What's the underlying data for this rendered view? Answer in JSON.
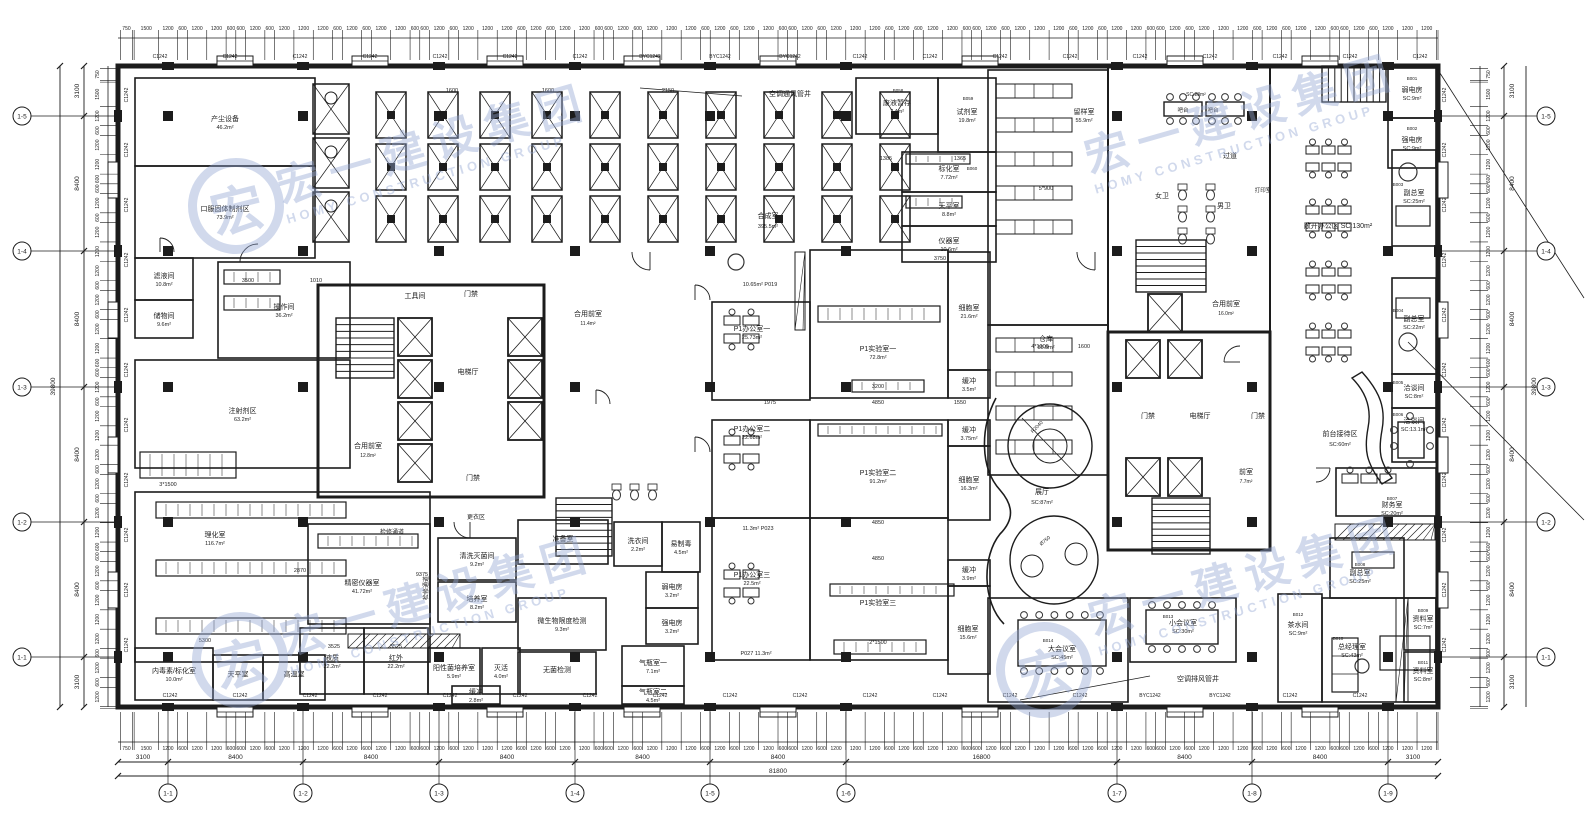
{
  "watermark": {
    "cn": "宏一建设集团",
    "en": "HOMY CONSTRUCTION GROUP",
    "logo_char": "宏",
    "color": "#93a7d4"
  },
  "window_label": "C1242",
  "window_label_alt": "BYC1242",
  "axis": {
    "h_total": "81800",
    "v_total": "39800",
    "h_spans": [
      [
        "3100",
        118,
        168
      ],
      [
        "8400",
        168,
        303
      ],
      [
        "8400",
        303,
        439
      ],
      [
        "8400",
        439,
        575
      ],
      [
        "8400",
        575,
        710
      ],
      [
        "8400",
        710,
        846
      ],
      [
        "16800",
        846,
        1117
      ],
      [
        "8400",
        1117,
        1252
      ],
      [
        "8400",
        1252,
        1388
      ],
      [
        "3100",
        1388,
        1438
      ]
    ],
    "v_spans": [
      [
        "3100",
        66,
        116
      ],
      [
        "8400",
        116,
        251
      ],
      [
        "8400",
        251,
        387
      ],
      [
        "8400",
        387,
        522
      ],
      [
        "8400",
        522,
        657
      ],
      [
        "3100",
        657,
        707
      ]
    ],
    "bottom_bubbles": [
      [
        "1-1",
        168
      ],
      [
        "1-2",
        303
      ],
      [
        "1-3",
        439
      ],
      [
        "1-4",
        575
      ],
      [
        "1-5",
        710
      ],
      [
        "1-6",
        846
      ],
      [
        "1-7",
        1117
      ],
      [
        "1-8",
        1252
      ],
      [
        "1-9",
        1388
      ]
    ],
    "left_bubbles": [
      [
        "1-5",
        116
      ],
      [
        "1-4",
        251
      ],
      [
        "1-3",
        387
      ],
      [
        "1-2",
        522
      ],
      [
        "1-1",
        657
      ]
    ],
    "tick_cycle": [
      1200,
      600,
      1200,
      1200,
      600,
      600,
      1200,
      600,
      1200,
      1200,
      1200,
      600
    ],
    "lead_in": [
      150,
      750,
      100,
      1500
    ]
  },
  "rooms": [
    {
      "n": "产尘设备",
      "a": "46.2m²",
      "r": [
        135,
        78,
        180,
        88
      ]
    },
    {
      "n": "口服固体制剂区",
      "a": "73.9m²",
      "r": [
        135,
        166,
        180,
        92
      ]
    },
    {
      "n": "滤液间",
      "a": "10.8m²",
      "r": [
        135,
        258,
        58,
        42
      ]
    },
    {
      "n": "储物间",
      "a": "9.6m²",
      "r": [
        135,
        300,
        58,
        38
      ]
    },
    {
      "n": "操作间",
      "a": "36.2m²",
      "r": [
        218,
        262,
        132,
        96
      ]
    },
    {
      "n": "注射剂区",
      "a": "63.2m²",
      "r": [
        135,
        360,
        215,
        108
      ]
    },
    {
      "n": "理化室",
      "a": "116.7m²",
      "r": [
        135,
        492,
        295,
        170
      ],
      "p": [
        215,
        538
      ]
    },
    {
      "n": "内毒素/标化室",
      "a": "10.0m²",
      "r": [
        135,
        648,
        78,
        52
      ]
    },
    {
      "n": "天平室",
      "a": "",
      "r": [
        213,
        655,
        50,
        45
      ]
    },
    {
      "n": "高温室",
      "a": "",
      "r": [
        263,
        655,
        62,
        45
      ]
    },
    {
      "n": "精密仪器室",
      "a": "41.72m²",
      "r": [
        308,
        524,
        122,
        100
      ],
      "p": [
        362,
        586
      ]
    },
    {
      "n": "液质",
      "a": "22.2m²",
      "r": [
        300,
        628,
        64,
        66
      ]
    },
    {
      "n": "红外",
      "a": "22.2m²",
      "r": [
        364,
        628,
        64,
        66
      ]
    },
    {
      "n": "准备室",
      "a": "",
      "r": [
        518,
        520,
        90,
        44
      ]
    },
    {
      "n": "清洗灭菌间",
      "a": "9.2m²",
      "r": [
        438,
        538,
        78,
        42
      ]
    },
    {
      "n": "培养室",
      "a": "8.2m²",
      "r": [
        438,
        582,
        78,
        40
      ]
    },
    {
      "n": "阳性菌培养室",
      "a": "5.9m²",
      "r": [
        428,
        648,
        52,
        46
      ]
    },
    {
      "n": "灭活",
      "a": "4.0m²",
      "r": [
        482,
        648,
        38,
        46
      ]
    },
    {
      "n": "缓冲",
      "a": "2.8m²",
      "r": [
        452,
        686,
        48,
        18
      ]
    },
    {
      "n": "微生物限度检测",
      "a": "9.3m²",
      "r": [
        518,
        598,
        88,
        52
      ]
    },
    {
      "n": "无菌检测",
      "a": "",
      "r": [
        518,
        652,
        78,
        42
      ]
    },
    {
      "n": "洗衣间",
      "a": "2.2m²",
      "r": [
        614,
        522,
        48,
        44
      ]
    },
    {
      "n": "易制毒",
      "a": "4.5m²",
      "r": [
        662,
        522,
        38,
        50
      ]
    },
    {
      "n": "弱电房",
      "a": "3.2m²",
      "r": [
        646,
        572,
        52,
        36
      ]
    },
    {
      "n": "强电房",
      "a": "3.2m²",
      "r": [
        646,
        608,
        52,
        36
      ]
    },
    {
      "n": "气瓶室一",
      "a": "7.1m²",
      "r": [
        622,
        646,
        62,
        40
      ]
    },
    {
      "n": "气瓶室二",
      "a": "4.5m²",
      "r": [
        622,
        686,
        62,
        18
      ]
    },
    {
      "n": "废液暂存",
      "a": "7.4m²",
      "r": [
        856,
        78,
        82,
        56
      ]
    },
    {
      "n": "试剂室",
      "a": "19.8m²",
      "r": [
        938,
        78,
        58,
        74
      ]
    },
    {
      "n": "标化室",
      "a": "7.72m²",
      "r": [
        902,
        152,
        94,
        40
      ]
    },
    {
      "n": "天平室",
      "a": "8.8m²",
      "r": [
        902,
        192,
        94,
        34
      ]
    },
    {
      "n": "仪器室",
      "a": "10.6m²",
      "r": [
        902,
        226,
        94,
        36
      ]
    },
    {
      "n": "留样室",
      "a": "55.9m²",
      "r": [
        988,
        70,
        120,
        255
      ],
      "p": [
        1084,
        115
      ]
    },
    {
      "n": "仓库",
      "a": "55.8m²",
      "r": [
        988,
        325,
        120,
        150
      ],
      "p": [
        1046,
        342
      ]
    },
    {
      "n": "P1办公室一",
      "a": "25.73m²",
      "r": [
        712,
        302,
        98,
        98
      ],
      "p": [
        752,
        332
      ]
    },
    {
      "n": "P1实验室一",
      "a": "72.8m²",
      "r": [
        810,
        250,
        138,
        148
      ],
      "p": [
        878,
        352
      ]
    },
    {
      "n": "细胞室",
      "a": "21.6m²",
      "r": [
        948,
        252,
        42,
        118
      ]
    },
    {
      "n": "缓冲",
      "a": "3.5m²",
      "r": [
        948,
        370,
        42,
        28
      ]
    },
    {
      "n": "P1办公室二",
      "a": "22.68m²",
      "r": [
        712,
        420,
        98,
        98
      ],
      "p": [
        752,
        432
      ]
    },
    {
      "n": "P1实验室二",
      "a": "91.2m²",
      "r": [
        810,
        420,
        138,
        98
      ],
      "p": [
        878,
        476
      ]
    },
    {
      "n": "缓冲",
      "a": "3.75m²",
      "r": [
        948,
        420,
        42,
        26
      ]
    },
    {
      "n": "细胞室",
      "a": "16.3m²",
      "r": [
        948,
        446,
        42,
        74
      ]
    },
    {
      "n": "P1办公室三",
      "a": "22.5m²",
      "r": [
        712,
        518,
        98,
        142
      ],
      "p": [
        752,
        578
      ]
    },
    {
      "n": "P1实验室三",
      "a": "",
      "r": [
        810,
        518,
        138,
        142
      ],
      "p": [
        878,
        606
      ]
    },
    {
      "n": "缓冲",
      "a": "3.9m²",
      "r": [
        948,
        560,
        42,
        26
      ]
    },
    {
      "n": "细胞室",
      "a": "15.6m²",
      "r": [
        948,
        586,
        42,
        88
      ],
      "p": [
        968,
        632
      ]
    },
    {
      "n": "弱电房",
      "a": "SC:9m²",
      "r": [
        1388,
        68,
        48,
        50
      ]
    },
    {
      "n": "强电房",
      "a": "SC:9m²",
      "r": [
        1388,
        118,
        48,
        50
      ]
    },
    {
      "n": "副总室",
      "a": "SC:25m²",
      "r": [
        1392,
        150,
        44,
        96
      ],
      "p": [
        1414,
        196
      ]
    },
    {
      "n": "副总室",
      "a": "SC:22m²",
      "r": [
        1392,
        278,
        44,
        96
      ],
      "p": [
        1414,
        322
      ]
    },
    {
      "n": "洽谈间",
      "a": "SC:8m²",
      "r": [
        1392,
        374,
        44,
        34
      ]
    },
    {
      "n": "洽谈间",
      "a": "SC:13.1m²",
      "r": [
        1392,
        408,
        44,
        54
      ],
      "p": [
        1414,
        424
      ]
    },
    {
      "n": "财务室",
      "a": "SC:20m²",
      "r": [
        1336,
        468,
        100,
        48
      ],
      "p": [
        1392,
        508
      ]
    },
    {
      "n": "副总室",
      "a": "SC:25m²",
      "r": [
        1330,
        538,
        74,
        60
      ],
      "p": [
        1360,
        576
      ]
    },
    {
      "n": "茶水间",
      "a": "SC:9m²",
      "r": [
        1278,
        594,
        44,
        108
      ],
      "p": [
        1298,
        628
      ]
    },
    {
      "n": "总经理室",
      "a": "SC:43m²",
      "r": [
        1322,
        598,
        114,
        104
      ],
      "p": [
        1352,
        650
      ]
    },
    {
      "n": "资料室",
      "a": "SC:7m²",
      "r": [
        1404,
        598,
        32,
        52
      ],
      "p": [
        1423,
        622
      ]
    },
    {
      "n": "资料室",
      "a": "SC:8m²",
      "r": [
        1404,
        652,
        32,
        50
      ],
      "p": [
        1423,
        674
      ]
    },
    {
      "n": "大会议室",
      "a": "SC:45m²",
      "r": [
        988,
        598,
        140,
        104
      ],
      "p": [
        1062,
        652
      ]
    },
    {
      "n": "小会议室",
      "a": "SC:30m²",
      "r": [
        1130,
        598,
        106,
        64
      ],
      "p": [
        1183,
        626
      ]
    }
  ],
  "labels": [
    {
      "t": "合成室",
      "p": [
        768,
        218
      ]
    },
    {
      "t": "395.5m²",
      "p": [
        768,
        228
      ],
      "s": 5.5
    },
    {
      "t": "电梯厅",
      "p": [
        468,
        374
      ]
    },
    {
      "t": "电梯厅",
      "p": [
        1200,
        418
      ]
    },
    {
      "t": "工具间",
      "p": [
        415,
        298
      ]
    },
    {
      "t": "门禁",
      "p": [
        471,
        296
      ]
    },
    {
      "t": "门禁",
      "p": [
        473,
        480
      ]
    },
    {
      "t": "门禁",
      "p": [
        1148,
        418
      ]
    },
    {
      "t": "门禁",
      "p": [
        1258,
        418
      ]
    },
    {
      "t": "合用前室",
      "p": [
        368,
        448
      ]
    },
    {
      "t": "12.8m²",
      "p": [
        368,
        457
      ],
      "s": 5
    },
    {
      "t": "合用前室",
      "p": [
        588,
        316
      ]
    },
    {
      "t": "11.4m²",
      "p": [
        588,
        325
      ],
      "s": 5
    },
    {
      "t": "合用前室",
      "p": [
        1226,
        306
      ]
    },
    {
      "t": "16.0m²",
      "p": [
        1226,
        315
      ],
      "s": 5
    },
    {
      "t": "前室",
      "p": [
        1246,
        474
      ]
    },
    {
      "t": "7.7m²",
      "p": [
        1246,
        483
      ],
      "s": 5
    },
    {
      "t": "展厅",
      "p": [
        1042,
        494
      ]
    },
    {
      "t": "SC:87m²",
      "p": [
        1042,
        504
      ],
      "s": 5.5
    },
    {
      "t": "过道",
      "p": [
        1230,
        158
      ]
    },
    {
      "t": "女卫",
      "p": [
        1162,
        198
      ]
    },
    {
      "t": "男卫",
      "p": [
        1224,
        208
      ]
    },
    {
      "t": "打印室",
      "p": [
        1263,
        192
      ],
      "s": 5.5
    },
    {
      "t": "吧台",
      "p": [
        1183,
        112
      ],
      "s": 5.5
    },
    {
      "t": "吧台",
      "p": [
        1213,
        112
      ],
      "s": 5.5
    },
    {
      "t": "SC:28m²",
      "p": [
        1196,
        96
      ],
      "s": 5
    },
    {
      "t": "敞开办公区 SC:130m²",
      "p": [
        1338,
        228
      ]
    },
    {
      "t": "前台接待区",
      "p": [
        1340,
        436
      ]
    },
    {
      "t": "SC:60m²",
      "p": [
        1340,
        446
      ],
      "s": 5.5
    },
    {
      "t": "空调通风管井",
      "p": [
        790,
        96
      ]
    },
    {
      "t": "空调排风管井",
      "p": [
        1198,
        681
      ]
    },
    {
      "t": "更衣区",
      "p": [
        476,
        519
      ],
      "s": 6
    },
    {
      "t": "检修通道",
      "p": [
        392,
        534
      ],
      "s": 6
    },
    {
      "t": "检修通道",
      "p": [
        428,
        588
      ],
      "s": 6,
      "v": true
    },
    {
      "t": "10.65m²  P019",
      "p": [
        760,
        286
      ],
      "s": 5.5
    },
    {
      "t": "11.3m²  P023",
      "p": [
        758,
        530
      ],
      "s": 5.5
    },
    {
      "t": "P027  11.3m²",
      "p": [
        756,
        655
      ],
      "s": 5.5
    },
    {
      "t": "B058",
      "p": [
        898,
        92
      ],
      "s": 4.5
    },
    {
      "t": "B059",
      "p": [
        968,
        100
      ],
      "s": 4.5
    },
    {
      "t": "B060",
      "p": [
        972,
        170
      ],
      "s": 4.5
    },
    {
      "t": "B001",
      "p": [
        1412,
        80
      ],
      "s": 4.5
    },
    {
      "t": "B002",
      "p": [
        1412,
        130
      ],
      "s": 4.5
    },
    {
      "t": "B003",
      "p": [
        1398,
        186
      ],
      "s": 4.5
    },
    {
      "t": "B004",
      "p": [
        1398,
        312
      ],
      "s": 4.5
    },
    {
      "t": "B005",
      "p": [
        1398,
        384
      ],
      "s": 4.5
    },
    {
      "t": "B006",
      "p": [
        1398,
        416
      ],
      "s": 4.5
    },
    {
      "t": "B007",
      "p": [
        1392,
        500
      ],
      "s": 4.5
    },
    {
      "t": "B008",
      "p": [
        1360,
        566
      ],
      "s": 4.5
    },
    {
      "t": "B010",
      "p": [
        1338,
        640
      ],
      "s": 4.5
    },
    {
      "t": "B012",
      "p": [
        1298,
        616
      ],
      "s": 4.5
    },
    {
      "t": "B009",
      "p": [
        1423,
        612
      ],
      "s": 4.5
    },
    {
      "t": "B011",
      "p": [
        1423,
        664
      ],
      "s": 4.5
    },
    {
      "t": "B013",
      "p": [
        1168,
        618
      ],
      "s": 4.5
    },
    {
      "t": "B014",
      "p": [
        1048,
        642
      ],
      "s": 4.5
    }
  ],
  "dim_texts": [
    [
      878,
      404,
      "4850"
    ],
    [
      770,
      404,
      "1975"
    ],
    [
      960,
      404,
      "1550"
    ],
    [
      878,
      524,
      "4850"
    ],
    [
      878,
      560,
      "4850"
    ],
    [
      1046,
      190,
      "5*900"
    ],
    [
      1040,
      348,
      "4*1000"
    ],
    [
      1084,
      348,
      "1600"
    ],
    [
      168,
      486,
      "3*1500"
    ],
    [
      878,
      644,
      "2*1500"
    ],
    [
      940,
      260,
      "3750"
    ],
    [
      300,
      572,
      "2870"
    ],
    [
      205,
      642,
      "5300"
    ],
    [
      422,
      576,
      "9375"
    ],
    [
      334,
      648,
      "3525"
    ],
    [
      396,
      648,
      "3525"
    ],
    [
      248,
      282,
      "3500"
    ],
    [
      316,
      282,
      "1010"
    ],
    [
      878,
      388,
      "3200"
    ],
    [
      668,
      92,
      "2150"
    ],
    [
      452,
      92,
      "1600"
    ],
    [
      548,
      92,
      "1600"
    ],
    [
      886,
      160,
      "1385"
    ],
    [
      960,
      160,
      "1365"
    ]
  ],
  "exhibit": {
    "r2040": "R2040",
    "d750": "Ø750"
  }
}
